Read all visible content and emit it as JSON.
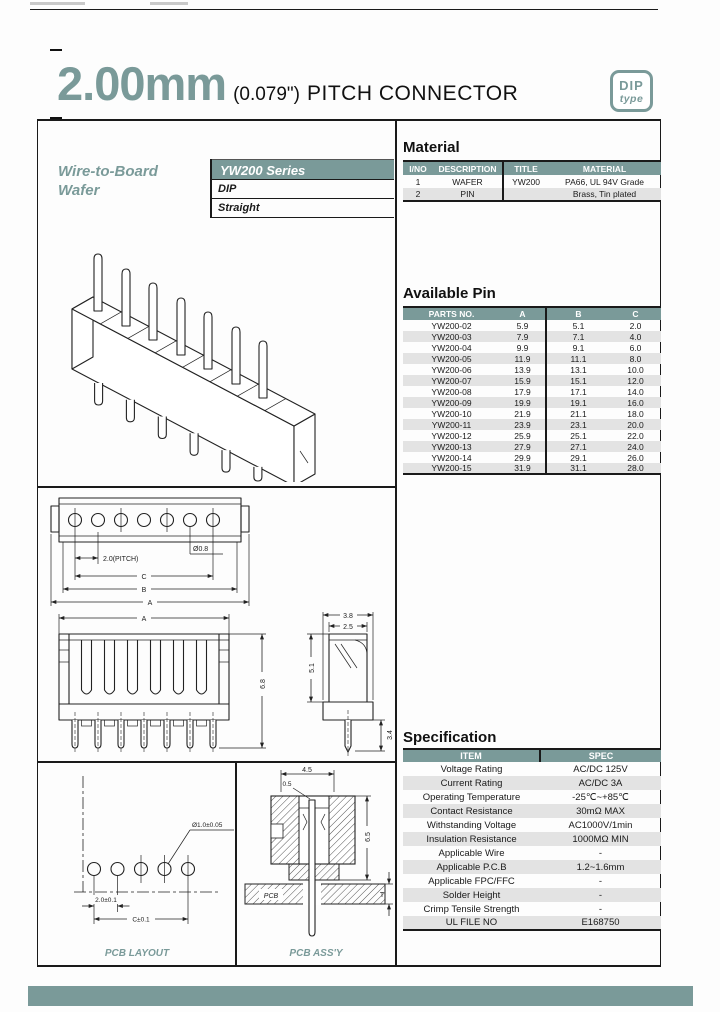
{
  "header": {
    "title_mm": "2.00mm",
    "title_inch": "(0.079\")",
    "title_text": "PITCH CONNECTOR",
    "badge": {
      "line1": "DIP",
      "line2": "type"
    }
  },
  "left_panel": {
    "category_line1": "Wire-to-Board",
    "category_line2": "Wafer",
    "series": "YW200 Series",
    "mount_type": "DIP",
    "orientation": "Straight"
  },
  "material": {
    "heading": "Material",
    "headers": [
      "I/NO",
      "DESCRIPTION",
      "TITLE",
      "MATERIAL"
    ],
    "rows": [
      [
        "1",
        "WAFER",
        "YW200",
        "PA66, UL 94V Grade"
      ],
      [
        "2",
        "PIN",
        "",
        "Brass, Tin plated"
      ]
    ]
  },
  "available_pin": {
    "heading": "Available Pin",
    "headers": [
      "PARTS NO.",
      "A",
      "B",
      "C"
    ],
    "rows": [
      [
        "YW200-02",
        "5.9",
        "5.1",
        "2.0"
      ],
      [
        "YW200-03",
        "7.9",
        "7.1",
        "4.0"
      ],
      [
        "YW200-04",
        "9.9",
        "9.1",
        "6.0"
      ],
      [
        "YW200-05",
        "11.9",
        "11.1",
        "8.0"
      ],
      [
        "YW200-06",
        "13.9",
        "13.1",
        "10.0"
      ],
      [
        "YW200-07",
        "15.9",
        "15.1",
        "12.0"
      ],
      [
        "YW200-08",
        "17.9",
        "17.1",
        "14.0"
      ],
      [
        "YW200-09",
        "19.9",
        "19.1",
        "16.0"
      ],
      [
        "YW200-10",
        "21.9",
        "21.1",
        "18.0"
      ],
      [
        "YW200-11",
        "23.9",
        "23.1",
        "20.0"
      ],
      [
        "YW200-12",
        "25.9",
        "25.1",
        "22.0"
      ],
      [
        "YW200-13",
        "27.9",
        "27.1",
        "24.0"
      ],
      [
        "YW200-14",
        "29.9",
        "29.1",
        "26.0"
      ],
      [
        "YW200-15",
        "31.9",
        "31.1",
        "28.0"
      ]
    ]
  },
  "specification": {
    "heading": "Specification",
    "headers": [
      "ITEM",
      "SPEC"
    ],
    "rows": [
      [
        "Voltage Rating",
        "AC/DC 125V"
      ],
      [
        "Current Rating",
        "AC/DC 3A"
      ],
      [
        "Operating Temperature",
        "-25℃~+85℃"
      ],
      [
        "Contact Resistance",
        "30mΩ MAX"
      ],
      [
        "Withstanding Voltage",
        "AC1000V/1min"
      ],
      [
        "Insulation Resistance",
        "1000MΩ MIN"
      ],
      [
        "Applicable Wire",
        "-"
      ],
      [
        "Applicable P.C.B",
        "1.2~1.6mm"
      ],
      [
        "Applicable FPC/FFC",
        "-"
      ],
      [
        "Solder Height",
        "-"
      ],
      [
        "Crimp Tensile Strength",
        "-"
      ],
      [
        "UL FILE NO",
        "E168750"
      ]
    ]
  },
  "drawings": {
    "top_view": {
      "pitch": "2.0(PITCH)",
      "hole": "Ø0.8",
      "dim_c": "C",
      "dim_b": "B",
      "dim_a": "A"
    },
    "front_view": {
      "dim_a": "A",
      "dim_height": "6.8"
    },
    "side_view": {
      "dim_38": "3.8",
      "dim_25": "2.5",
      "dim_51": "5.1",
      "dim_34": "3.4"
    },
    "pcb_layout": {
      "label": "PCB LAYOUT",
      "hole": "Ø1.0±0.05",
      "pitch": "2.0±0.1",
      "span": "C±0.1"
    },
    "pcb_assy": {
      "label": "PCB ASS'Y",
      "dim_45": "4.5",
      "dim_05": "0.5",
      "dim_65": "6.5",
      "dim_t": "T",
      "pcb": "PCB"
    }
  },
  "colors": {
    "accent": "#7a9a99",
    "row_alt": "#e3e3e3"
  }
}
